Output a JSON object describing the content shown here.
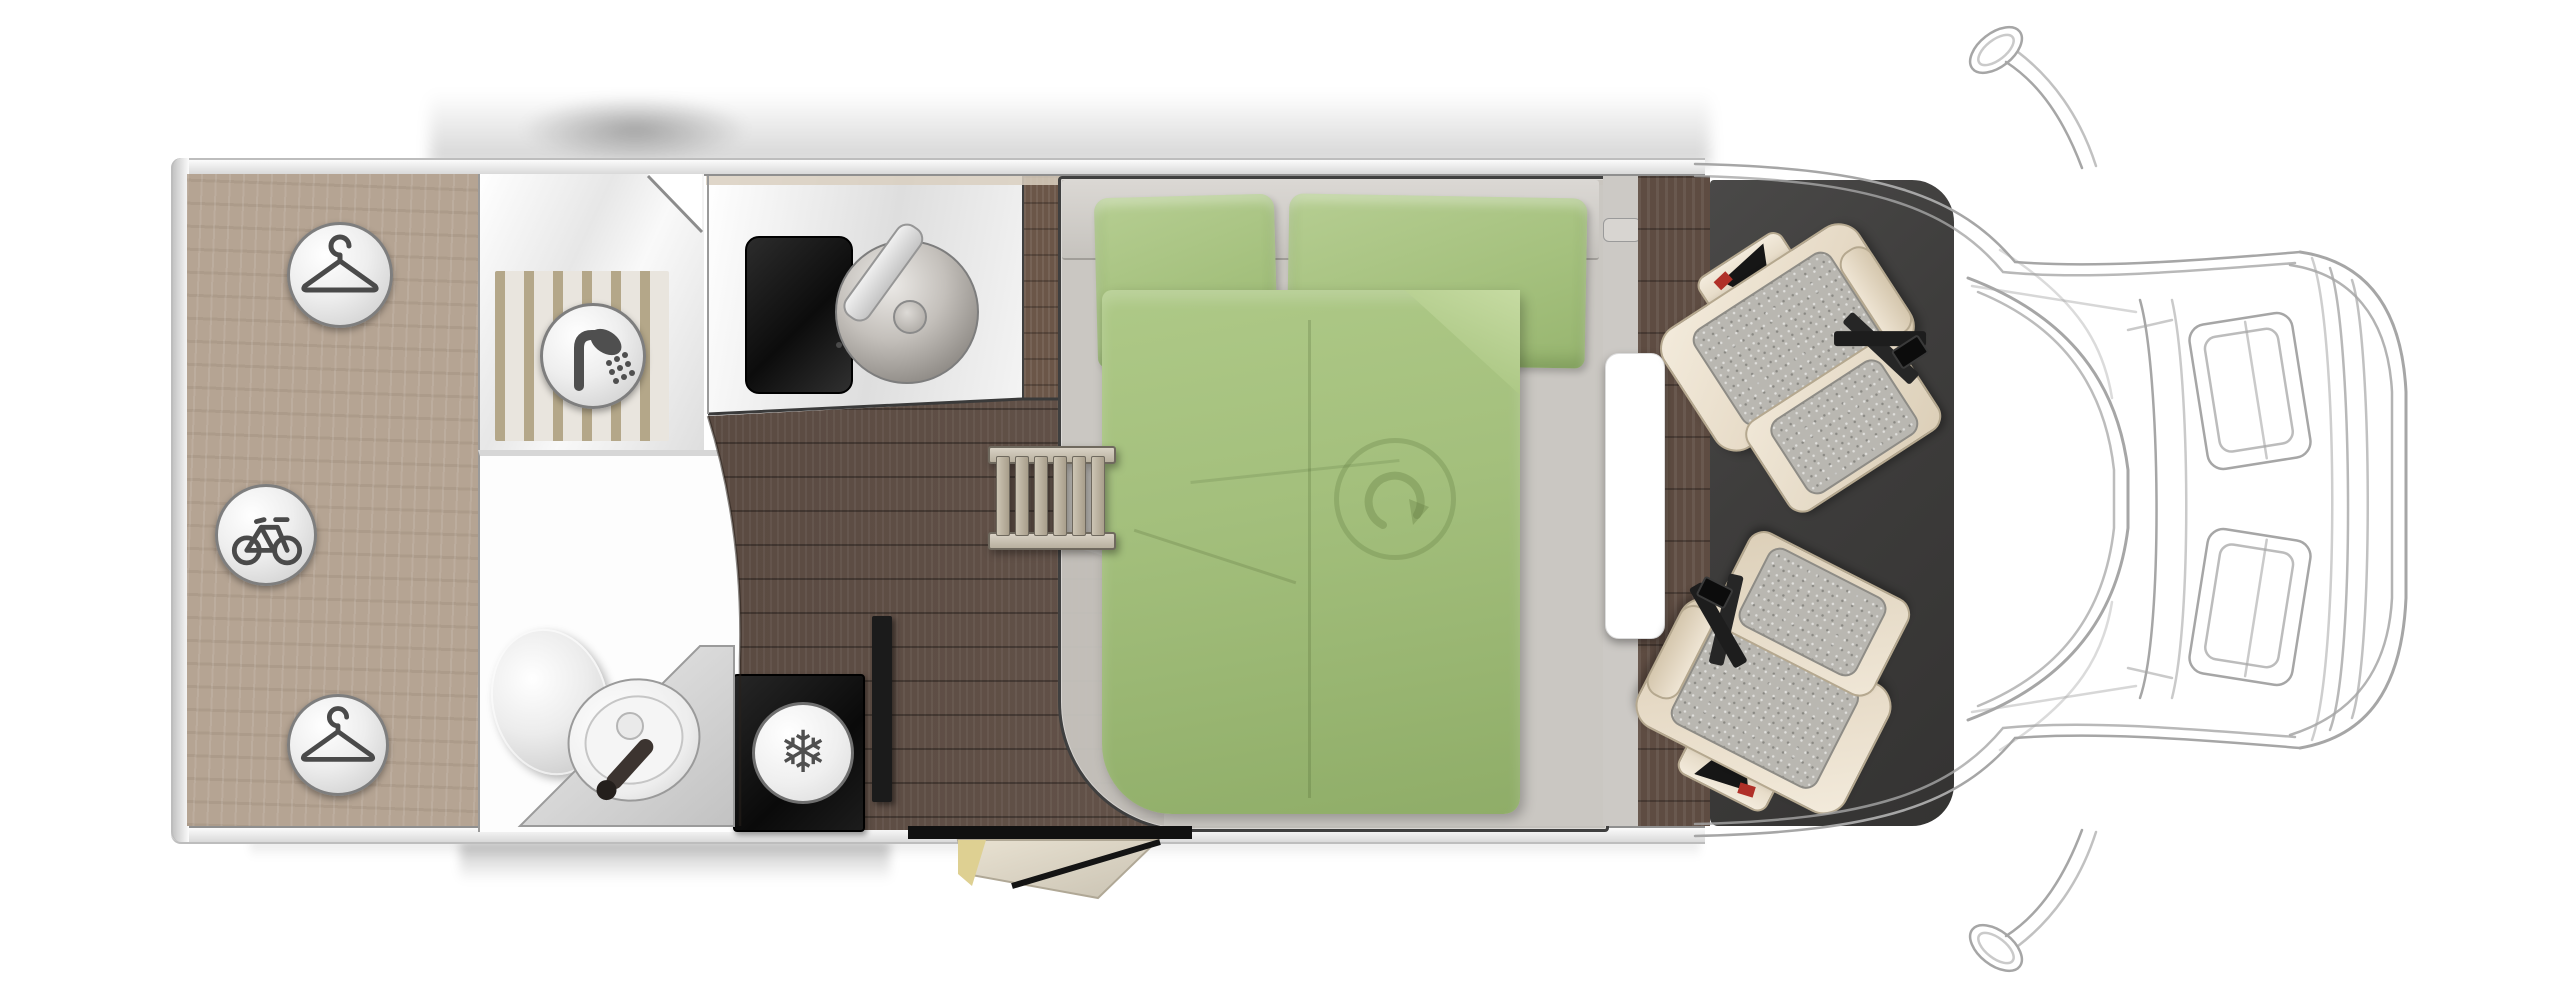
{
  "scene": {
    "type": "motorhome-floorplan-top-view",
    "background": "#ffffff"
  },
  "regions": {
    "garage": "rear-garage-wardrobe",
    "shower": "shower-room",
    "washroom": "washroom-toilet-vanity",
    "kitchen": "kitchen-block",
    "fridge": "refrigerator",
    "corridor": "corridor-floor",
    "bedroom": "island-bed",
    "ladder": "bed-ladder-step",
    "cab": "cab-swivel-seats",
    "front": "vehicle-front-wireframe",
    "entry": "entry-step-door"
  },
  "icons": {
    "garage_badges": [
      {
        "name": "hanger-icon"
      },
      {
        "name": "bicycle-icon"
      },
      {
        "name": "hanger-icon"
      }
    ],
    "shower_badge": {
      "name": "shower-icon"
    },
    "fridge_badge": {
      "name": "snowflake-icon",
      "glyph": "❄"
    },
    "duvet_emblem": {
      "name": "curved-arrow-icon"
    }
  },
  "colors": {
    "wardrobe_wood": "#b5a493",
    "corridor_wood": "#5e4c42",
    "cab_mat": "#3e3d3c",
    "bedding_green": "#a3bf7c",
    "mattress_grey": "#c8c5c0",
    "seat_cream": "#eee5d4",
    "seat_pad_grey": "#b9b7b1",
    "cooktop_black": "#141414",
    "stripe_tan": "#b4a789",
    "wireframe_grey": "#a6a6a6",
    "step_yellow": "#ded092",
    "accent_red": "#b03028"
  }
}
